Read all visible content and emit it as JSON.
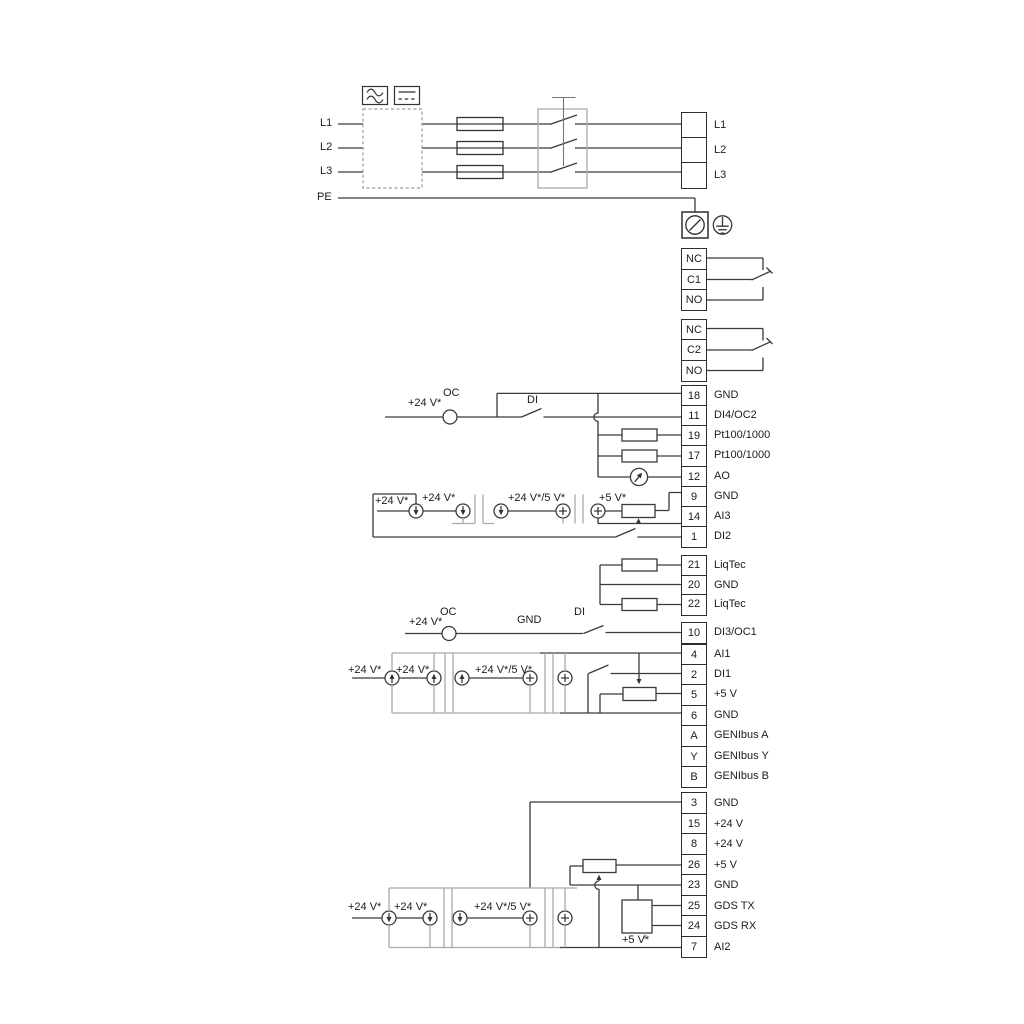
{
  "diagram_title": "",
  "terminal_strips": [
    {
      "id": "mains-output",
      "cells": [
        {
          "num": "",
          "label": "L1"
        },
        {
          "num": "",
          "label": "L2"
        },
        {
          "num": "",
          "label": "L3"
        }
      ]
    },
    {
      "id": "relay-1",
      "cells": [
        {
          "num": "NC",
          "label": ""
        },
        {
          "num": "C1",
          "label": ""
        },
        {
          "num": "NO",
          "label": ""
        }
      ]
    },
    {
      "id": "relay-2",
      "cells": [
        {
          "num": "NC",
          "label": ""
        },
        {
          "num": "C2",
          "label": ""
        },
        {
          "num": "NO",
          "label": ""
        }
      ]
    },
    {
      "id": "io-a",
      "cells": [
        {
          "num": "18",
          "label": "GND"
        },
        {
          "num": "11",
          "label": "DI4/OC2"
        },
        {
          "num": "19",
          "label": "Pt100/1000"
        },
        {
          "num": "17",
          "label": "Pt100/1000"
        },
        {
          "num": "12",
          "label": "AO"
        },
        {
          "num": "9",
          "label": "GND"
        },
        {
          "num": "14",
          "label": "AI3"
        },
        {
          "num": "1",
          "label": "DI2"
        }
      ]
    },
    {
      "id": "liqtec",
      "cells": [
        {
          "num": "21",
          "label": "LiqTec"
        },
        {
          "num": "20",
          "label": "GND"
        },
        {
          "num": "22",
          "label": "LiqTec"
        }
      ]
    },
    {
      "id": "di3",
      "cells": [
        {
          "num": "10",
          "label": "DI3/OC1"
        }
      ]
    },
    {
      "id": "io-d",
      "cells": [
        {
          "num": "4",
          "label": "AI1"
        },
        {
          "num": "2",
          "label": "DI1"
        },
        {
          "num": "5",
          "label": "+5 V"
        },
        {
          "num": "6",
          "label": "GND"
        },
        {
          "num": "A",
          "label": "GENIbus A"
        },
        {
          "num": "Y",
          "label": "GENIbus Y"
        },
        {
          "num": "B",
          "label": "GENIbus B"
        }
      ]
    },
    {
      "id": "io-e",
      "cells": [
        {
          "num": "3",
          "label": "GND"
        },
        {
          "num": "15",
          "label": "+24 V"
        },
        {
          "num": "8",
          "label": "+24 V"
        },
        {
          "num": "26",
          "label": "+5 V"
        },
        {
          "num": "23",
          "label": "GND"
        },
        {
          "num": "25",
          "label": "GDS TX"
        },
        {
          "num": "24",
          "label": "GDS RX"
        },
        {
          "num": "7",
          "label": "AI2"
        }
      ]
    }
  ],
  "annotations": [
    {
      "id": "mains-l1",
      "text": "L1"
    },
    {
      "id": "mains-l2",
      "text": "L2"
    },
    {
      "id": "mains-l3",
      "text": "L3"
    },
    {
      "id": "mains-pe",
      "text": "PE"
    },
    {
      "id": "oc1-24v",
      "text": "+24 V*"
    },
    {
      "id": "oc1-oc",
      "text": "OC"
    },
    {
      "id": "di4-di",
      "text": "DI"
    },
    {
      "id": "ai3-24v-1",
      "text": "+24 V*"
    },
    {
      "id": "ai3-24v-2",
      "text": "+24 V*"
    },
    {
      "id": "ai3-24v5v",
      "text": "+24 V*/5 V*"
    },
    {
      "id": "ai3-5v",
      "text": "+5 V*"
    },
    {
      "id": "oc2-24v",
      "text": "+24 V*"
    },
    {
      "id": "oc2-oc",
      "text": "OC"
    },
    {
      "id": "oc2-gnd",
      "text": "GND"
    },
    {
      "id": "di3-di",
      "text": "DI"
    },
    {
      "id": "ai1-24v-1",
      "text": "+24 V*"
    },
    {
      "id": "ai1-24v-2",
      "text": "+24 V*"
    },
    {
      "id": "ai1-24v5v",
      "text": "+24 V*/5 V*"
    },
    {
      "id": "ai2-24v-1",
      "text": "+24 V*"
    },
    {
      "id": "ai2-24v-2",
      "text": "+24 V*"
    },
    {
      "id": "ai2-24v5v",
      "text": "+24 V*/5 V*"
    },
    {
      "id": "gds-5v",
      "text": "+5 V*"
    }
  ],
  "colors": {
    "wire": "#3a3a3a",
    "outline_gray": "#a9a9a9",
    "ink": "#1c1c1c"
  }
}
